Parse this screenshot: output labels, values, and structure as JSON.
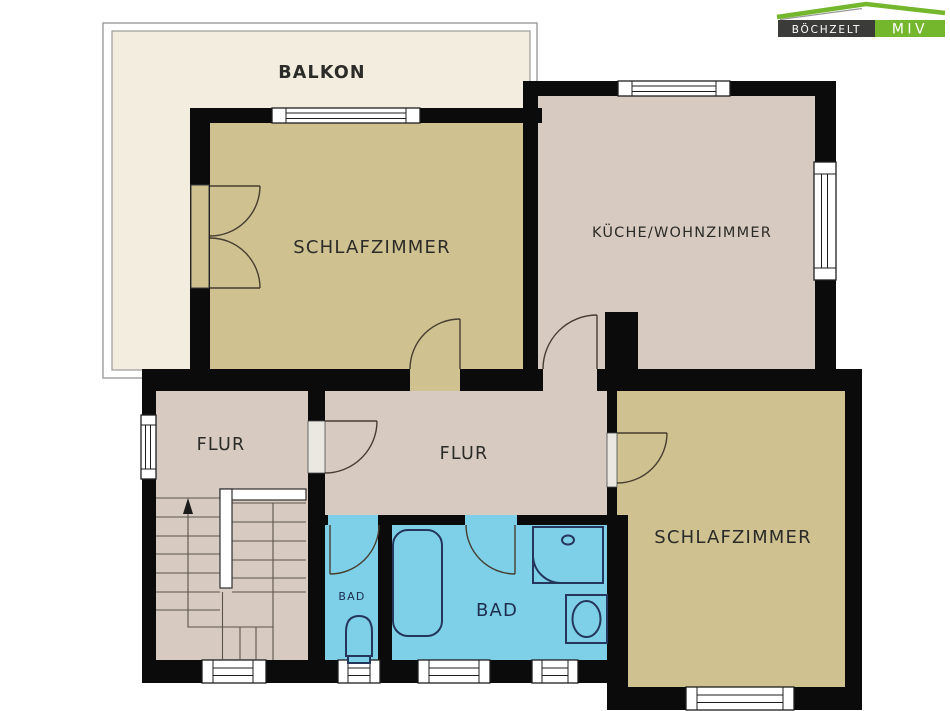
{
  "palette": {
    "wall": "#0b0b0b",
    "room-tan": "#cfc190",
    "room-pink": "#d7cac0",
    "room-blue": "#7ed0e8",
    "balcony-cream": "#f2edde",
    "balcony-border": "#9b9b99",
    "label": "#2b2b28",
    "label-navy": "#1e2d4f",
    "fixture": "#24365c",
    "arc": "#473e30",
    "step": "#5a544c",
    "logo-dark": "#3b3b3a",
    "logo-green": "#74b62c"
  },
  "rooms": {
    "balkon": "BALKON",
    "schlafzimmer_left": "SCHLAFZIMMER",
    "kueche_wohnzimmer": "KÜCHE/WOHNZIMMER",
    "flur_left": "FLUR",
    "flur_mitte": "FLUR",
    "bad_klein": "BAD",
    "bad_gross": "BAD",
    "schlafzimmer_right": "SCHLAFZIMMER"
  },
  "logo": {
    "brand": "BÖCHZELT",
    "division": "MIV"
  }
}
